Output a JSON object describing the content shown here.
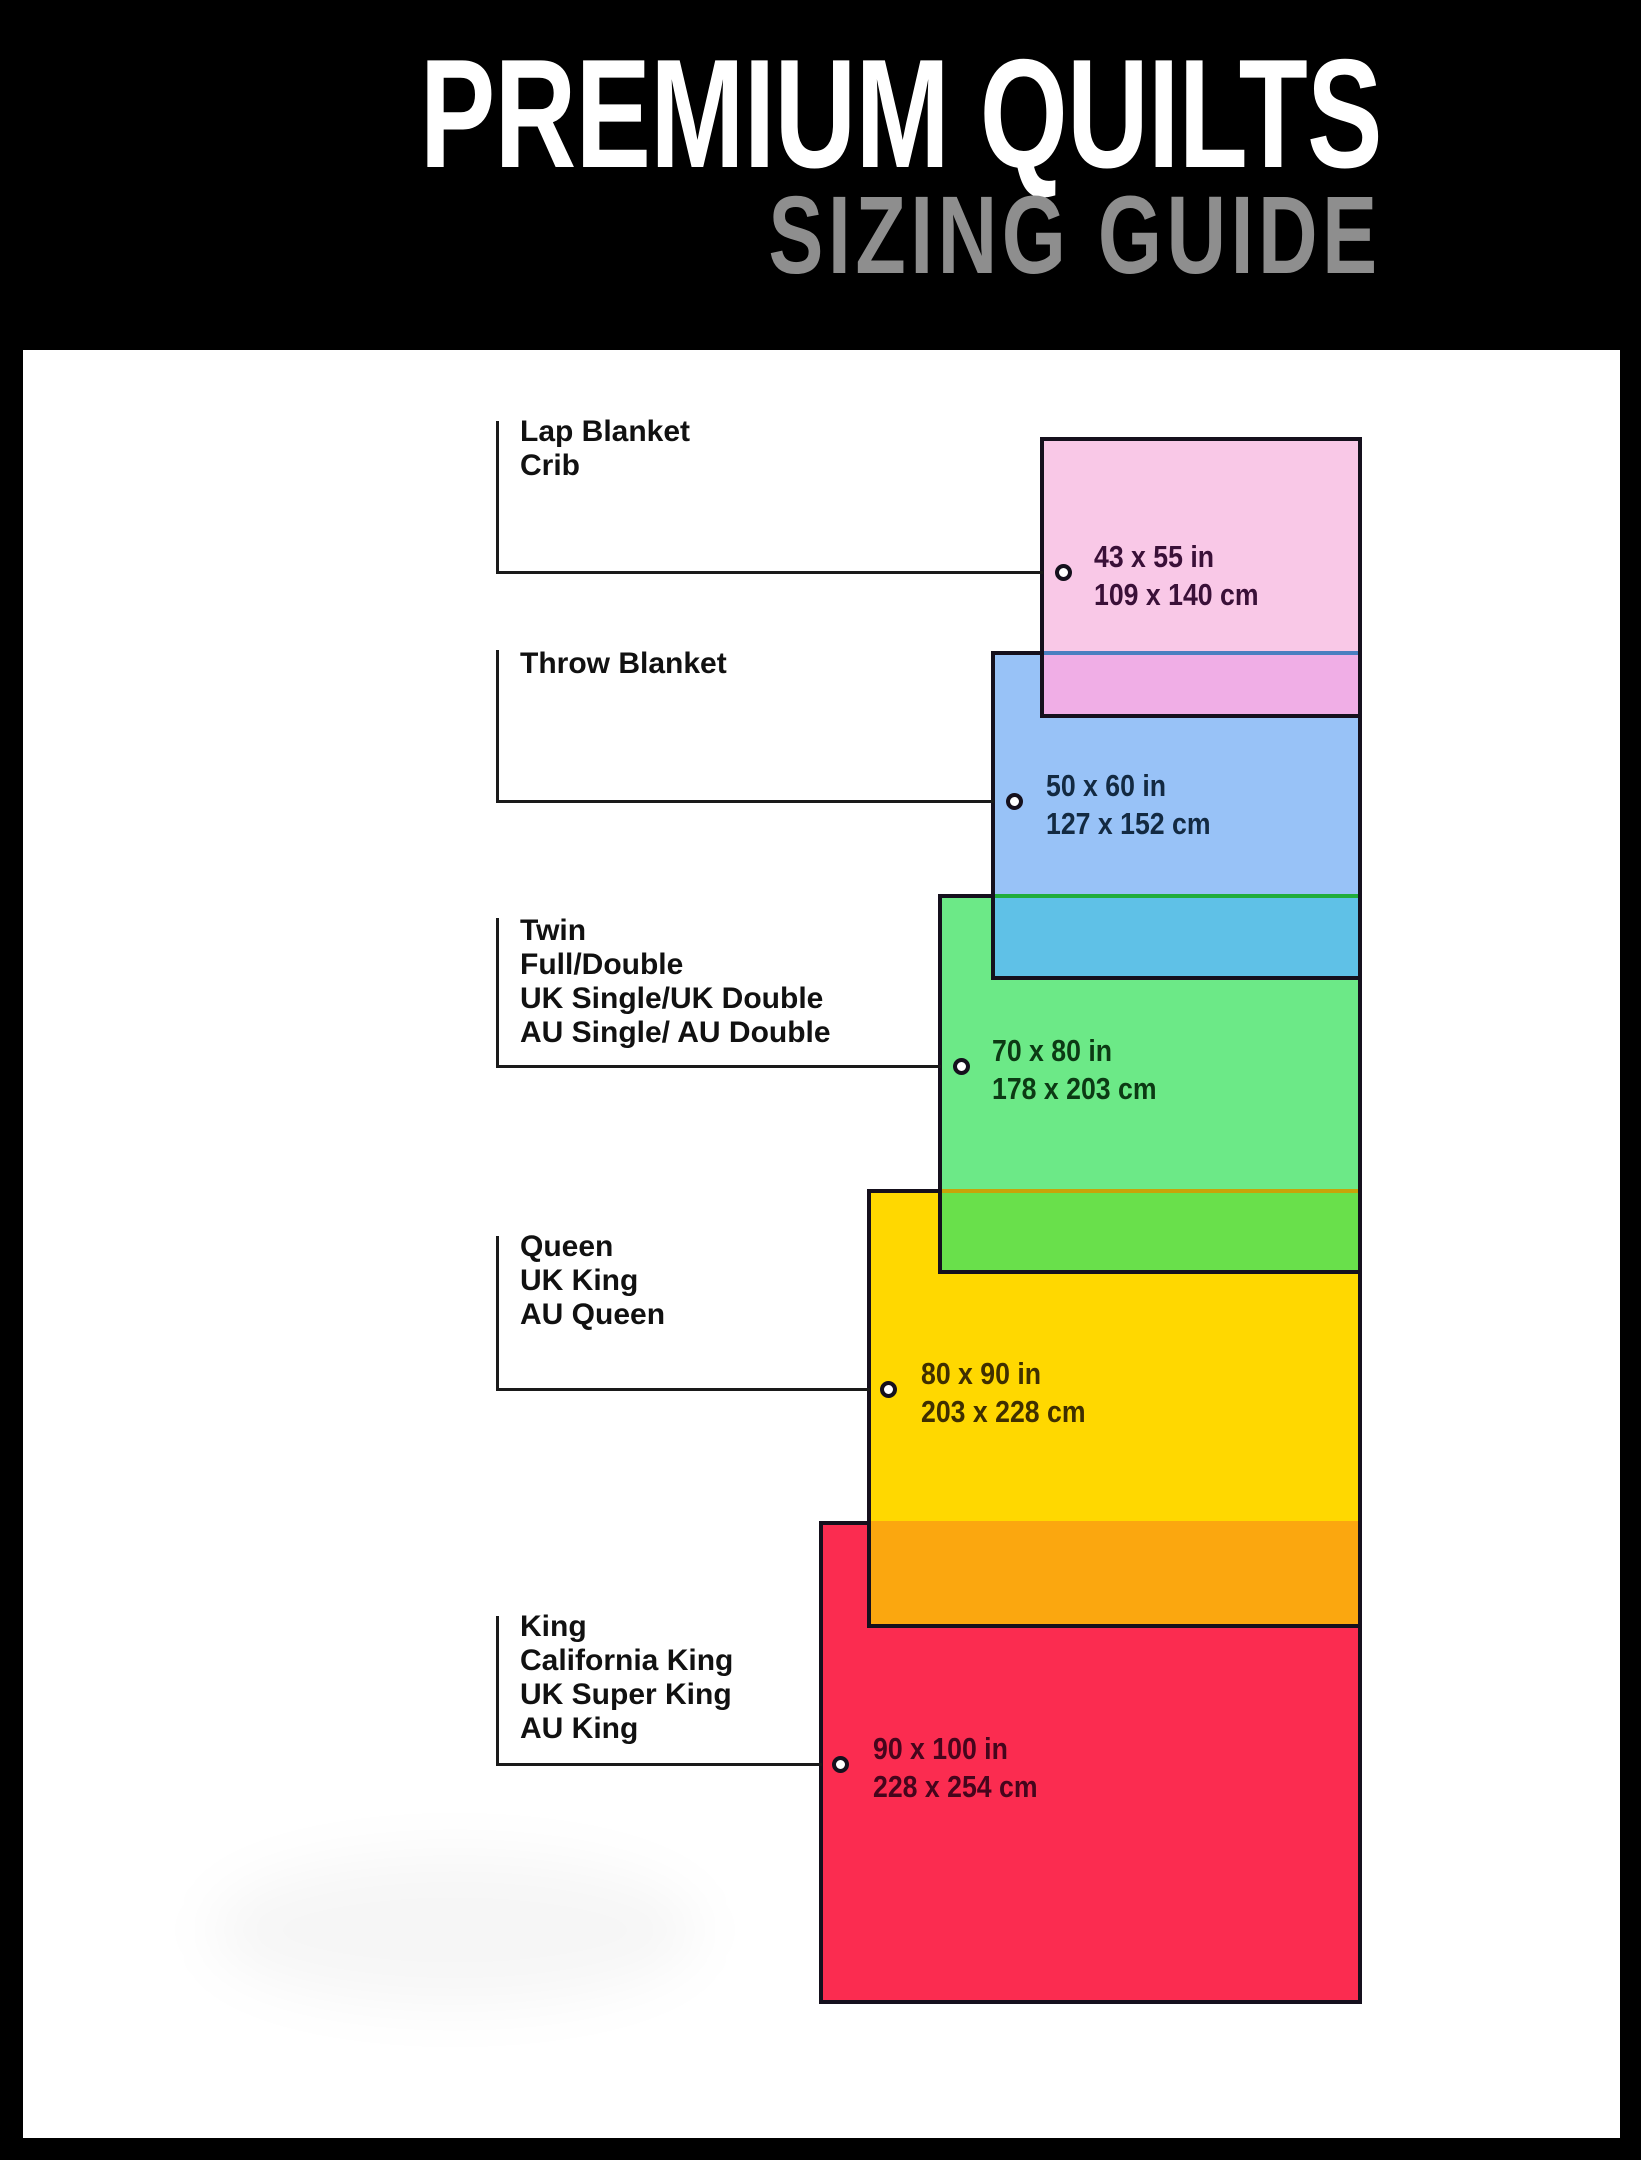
{
  "header": {
    "title": "PREMIUM QUILTS",
    "subtitle": "SIZING GUIDE",
    "background": "#000000",
    "title_color": "#ffffff",
    "subtitle_color": "#8e8e8e"
  },
  "sizes": [
    {
      "id": "lap-blanket-crib",
      "labels": [
        "Lap Blanket",
        "Crib"
      ],
      "inches": "43 x 55 in",
      "cm": "109 x 140 cm",
      "fill": "#f9c8e7",
      "overlap_fill": "#f0aee6",
      "divider_color": "#bd5f9d",
      "text_color": "#3a1038"
    },
    {
      "id": "throw-blanket",
      "labels": [
        "Throw Blanket"
      ],
      "inches": "50 x 60 in",
      "cm": "127 x 152 cm",
      "fill": "#98c2f7",
      "overlap_fill": "#5fc1e7",
      "divider_color": "#4a7fc1",
      "text_color": "#132a42"
    },
    {
      "id": "twin-full-double",
      "labels": [
        "Twin",
        "Full/Double",
        "UK Single/UK Double",
        "AU Single/ AU Double"
      ],
      "inches": "70 x 80 in",
      "cm": "178 x 203 cm",
      "fill": "#6ce987",
      "overlap_fill": "#69e04b",
      "divider_color": "#21ad3c",
      "text_color": "#0c3a14"
    },
    {
      "id": "queen-uk-king-au-queen",
      "labels": [
        "Queen",
        "UK King",
        "AU Queen"
      ],
      "inches": "80 x 90 in",
      "cm": "203 x 228 cm",
      "fill": "#ffd800",
      "overlap_fill": "#fba70f",
      "divider_color": "#c7a408",
      "text_color": "#3f2f00"
    },
    {
      "id": "king-california-king",
      "labels": [
        "King",
        "California King",
        "UK Super King",
        "AU King"
      ],
      "inches": "90 x 100 in",
      "cm": "228 x 254 cm",
      "fill": "#fb2c50",
      "overlap_fill": null,
      "divider_color": null,
      "text_color": "#45051c"
    }
  ],
  "border_color": "#15101d",
  "connector_color": "#1a1a1a"
}
